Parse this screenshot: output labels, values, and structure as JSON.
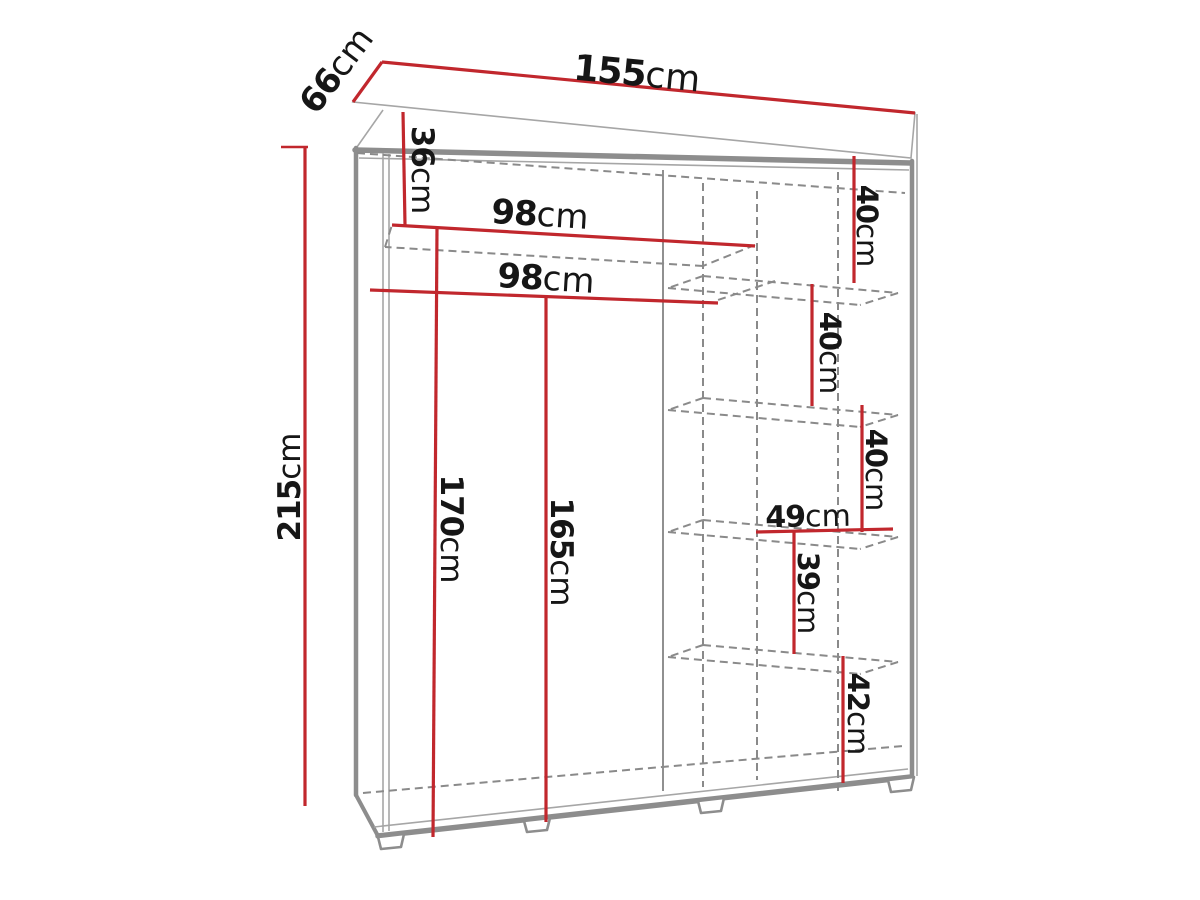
{
  "diagram": {
    "kind": "wardrobe-dimension-drawing",
    "unit": "cm",
    "colors": {
      "dimension_line": "#c1272d",
      "outline": "#8d8d8d",
      "hidden_line": "#8a8a8a",
      "label_text": "#161616",
      "background": "#ffffff"
    }
  },
  "labels": [
    {
      "id": "overall-width",
      "value": "155",
      "unit": "cm"
    },
    {
      "id": "overall-depth",
      "value": "66",
      "unit": "cm"
    },
    {
      "id": "overall-height",
      "value": "215",
      "unit": "cm"
    },
    {
      "id": "top-shelf-offset",
      "value": "36",
      "unit": "cm"
    },
    {
      "id": "upper-rod-width",
      "value": "98",
      "unit": "cm"
    },
    {
      "id": "lower-rod-width",
      "value": "98",
      "unit": "cm"
    },
    {
      "id": "left-interior-height",
      "value": "170",
      "unit": "cm"
    },
    {
      "id": "right-interior-height",
      "value": "165",
      "unit": "cm"
    },
    {
      "id": "shelf-gap-1",
      "value": "40",
      "unit": "cm"
    },
    {
      "id": "shelf-gap-2",
      "value": "40",
      "unit": "cm"
    },
    {
      "id": "shelf-gap-3",
      "value": "40",
      "unit": "cm"
    },
    {
      "id": "shelf-column-width",
      "value": "49",
      "unit": "cm"
    },
    {
      "id": "shelf-gap-4",
      "value": "39",
      "unit": "cm"
    },
    {
      "id": "shelf-gap-5",
      "value": "42",
      "unit": "cm"
    }
  ]
}
